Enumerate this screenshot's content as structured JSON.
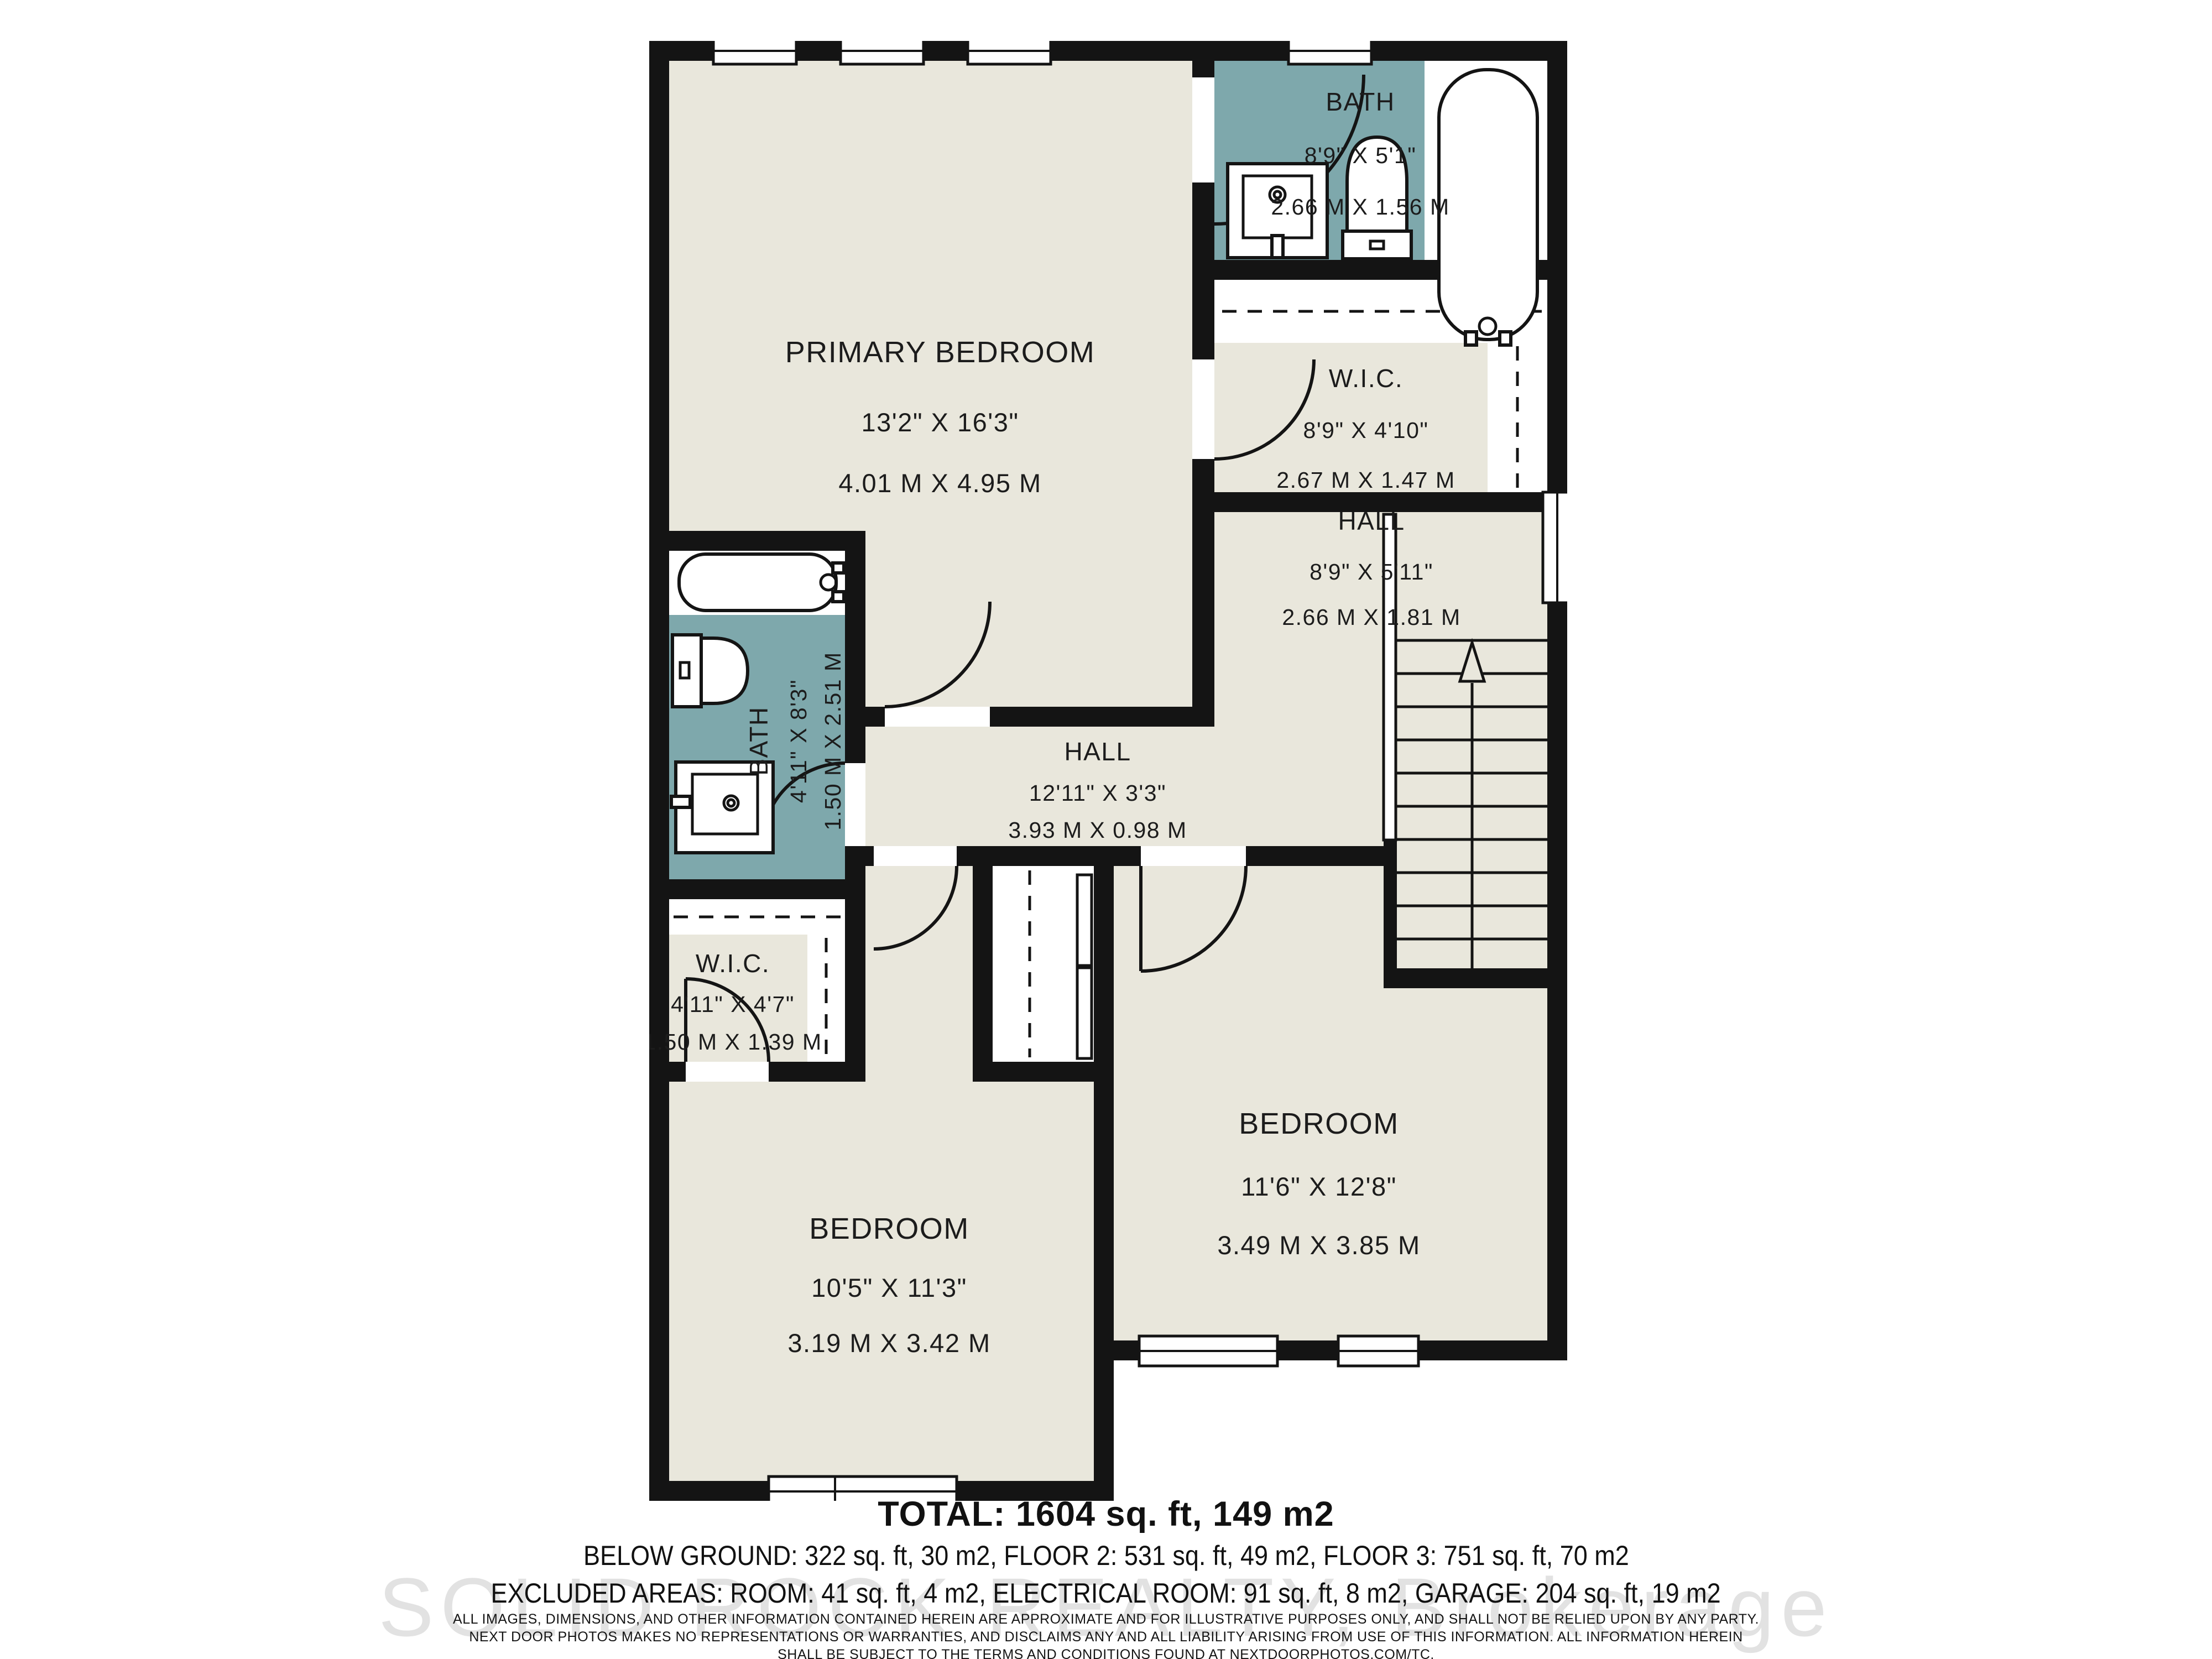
{
  "floorplan": {
    "colors": {
      "floor": "#e9e7dc",
      "wet_room": "#7ea8ac",
      "wall": "#141414",
      "line": "#1c1c1c"
    },
    "rooms": {
      "primary_bedroom": {
        "name": "PRIMARY BEDROOM",
        "imperial": "13'2\" X 16'3\"",
        "metric": "4.01 M X 4.95 M"
      },
      "bath_ensuite": {
        "name": "BATH",
        "imperial": "8'9\" X 5'1\"",
        "metric": "2.66 M X 1.56 M"
      },
      "wic_primary": {
        "name": "W.I.C.",
        "imperial": "8'9\" X 4'10\"",
        "metric": "2.67 M X 1.47 M"
      },
      "hall_upper": {
        "name": "HALL",
        "imperial": "8'9\" X 5'11\"",
        "metric": "2.66 M X 1.81 M"
      },
      "bath_main": {
        "name": "BATH",
        "imperial": "4'11\" X 8'3\"",
        "metric": "1.50 M X 2.51 M"
      },
      "hall_center": {
        "name": "HALL",
        "imperial": "12'11\" X 3'3\"",
        "metric": "3.93 M X 0.98 M"
      },
      "wic_left": {
        "name": "W.I.C.",
        "imperial": "4'11\" X 4'7\"",
        "metric": "1.50 M X 1.39 M"
      },
      "bedroom_left": {
        "name": "BEDROOM",
        "imperial": "10'5\" X 11'3\"",
        "metric": "3.19 M X 3.42 M"
      },
      "bedroom_right": {
        "name": "BEDROOM",
        "imperial": "11'6\" X 12'8\"",
        "metric": "3.49 M X 3.85 M"
      }
    }
  },
  "summary": {
    "total": "TOTAL: 1604 sq. ft, 149 m2",
    "floors": "BELOW GROUND: 322 sq. ft, 30 m2, FLOOR 2: 531 sq. ft, 49 m2, FLOOR 3: 751 sq. ft, 70 m2",
    "excluded": "EXCLUDED AREAS: ROOM: 41 sq. ft, 4 m2, ELECTRICAL ROOM: 91 sq. ft, 8 m2, GARAGE: 204 sq. ft, 19 m2"
  },
  "disclaimer": {
    "line1": "ALL IMAGES, DIMENSIONS, AND OTHER INFORMATION CONTAINED HEREIN ARE APPROXIMATE AND FOR ILLUSTRATIVE PURPOSES ONLY, AND SHALL NOT BE RELIED UPON BY ANY PARTY.",
    "line2": "NEXT DOOR PHOTOS MAKES NO REPRESENTATIONS OR WARRANTIES, AND DISCLAIMS ANY AND ALL LIABILITY ARISING FROM USE OF THIS INFORMATION. ALL INFORMATION HEREIN",
    "line3": "SHALL BE SUBJECT TO THE TERMS AND CONDITIONS FOUND AT NEXTDOORPHOTOS.COM/TC."
  },
  "watermark": {
    "text": "SOLID ROCK REALTY, Brokerage"
  }
}
